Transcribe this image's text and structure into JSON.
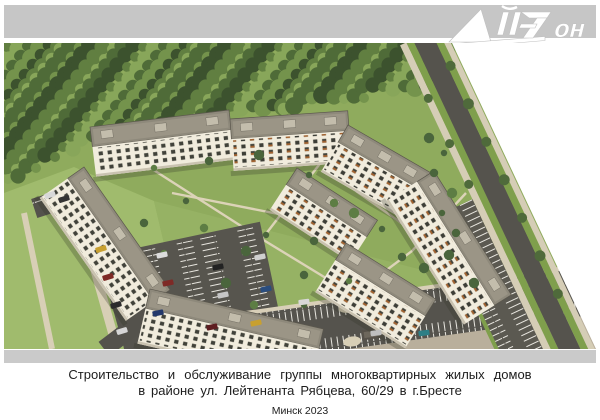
{
  "header": {
    "logo_text": "АйЗон",
    "logo_text_tail": "он",
    "band_color": "#c6c6c6"
  },
  "rendering": {
    "description": "Aerial 3D visualization of a group of multi-apartment residential buildings with landscaped courtyards, parking lots, access roads and surrounding forest",
    "colors": {
      "forest_green": "#4a6036",
      "lawn_green": "#92af5e",
      "asphalt": "#55534d",
      "roof_gray": "#8e897b",
      "facade_cream": "#f1ecdd",
      "window_dark": "#41423a",
      "accent_orange": "#a2622f",
      "path_beige": "#dcd3b8",
      "plaza_beige": "#b9af9c",
      "header_gray": "#c6c6c6",
      "footer_gray": "#cacaca"
    }
  },
  "caption": {
    "line1": "Строительство и обслуживание группы многоквартирных жилых домов",
    "line2": "в районе ул. Лейтенанта Рябцева, 60/29 в г.Бресте",
    "line3": "Минск 2023"
  }
}
